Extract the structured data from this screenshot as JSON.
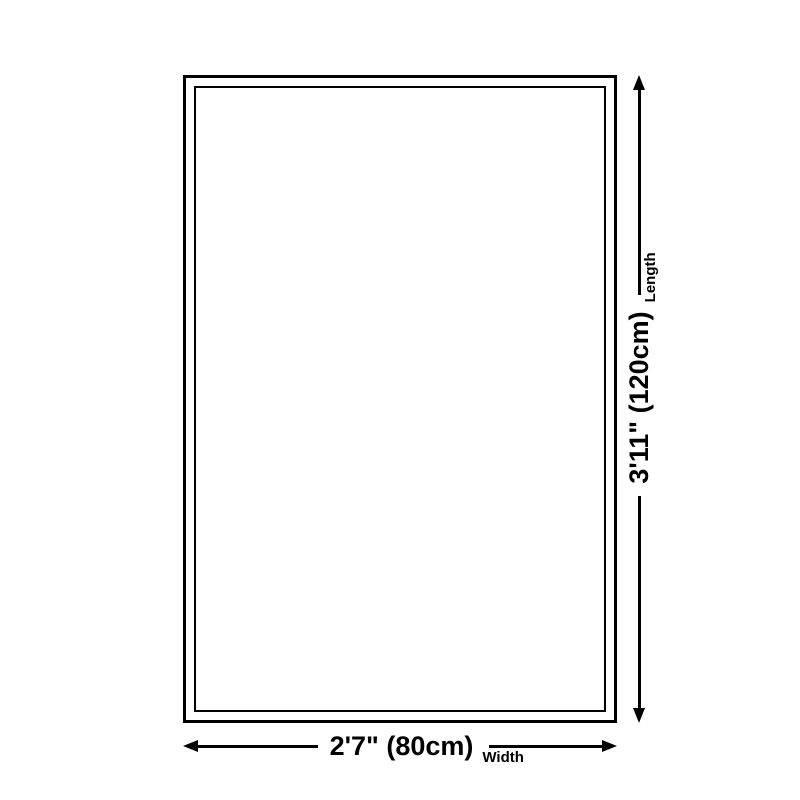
{
  "diagram": {
    "background_color": "#ffffff",
    "line_color": "#000000",
    "shape": "rectangle-double-border"
  },
  "icons": {
    "arrowhead_left": "triangle-left",
    "arrowhead_right": "triangle-right",
    "arrowhead_up": "triangle-up",
    "arrowhead_down": "triangle-down"
  },
  "dimensions": {
    "width": {
      "value": "2'7\" (80cm)",
      "label": "Width"
    },
    "length": {
      "value": "3'11\" (120cm)",
      "label": "Length"
    }
  }
}
